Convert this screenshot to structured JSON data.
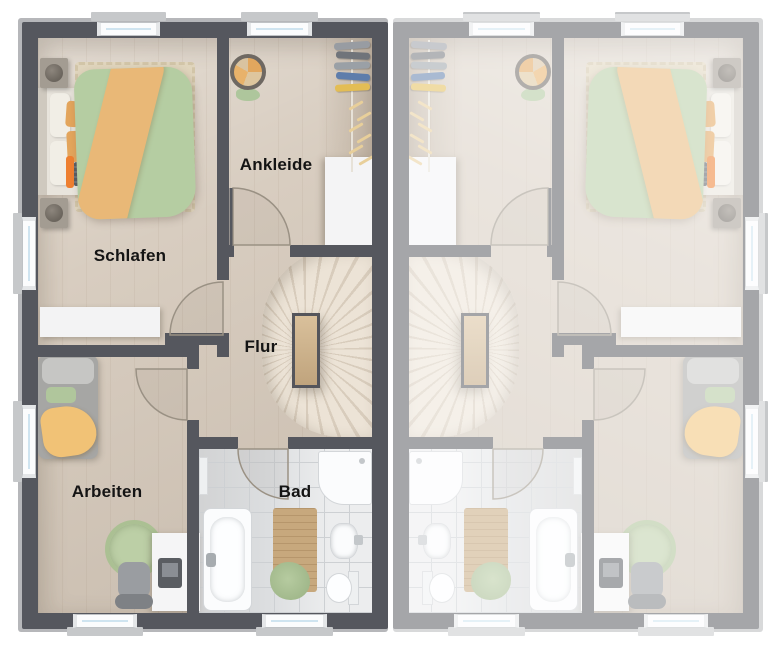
{
  "rooms": {
    "schlafen": "Schlafen",
    "ankleide": "Ankleide",
    "flur": "Flur",
    "arbeiten": "Arbeiten",
    "bad": "Bad"
  },
  "units": {
    "left": {
      "labels_visible": true,
      "style": "dark-walls"
    },
    "right": {
      "labels_visible": false,
      "style": "faded-mirrored-duplicate"
    }
  },
  "colors": {
    "background": "#ffffff",
    "wall_dark": "#55575e",
    "wall_mirror_light": "#a6a7ab",
    "outer_band": "#b6b7ba",
    "floor_wood": "#d8cdc0",
    "bath_tile": "#dcdee0",
    "stair_wood": "#e6ddcf",
    "accent_green": "#b5cda2",
    "accent_orange": "#e9b877",
    "accent_orange_bright": "#ee7f30",
    "fixture_white": "#fbfcfd"
  }
}
